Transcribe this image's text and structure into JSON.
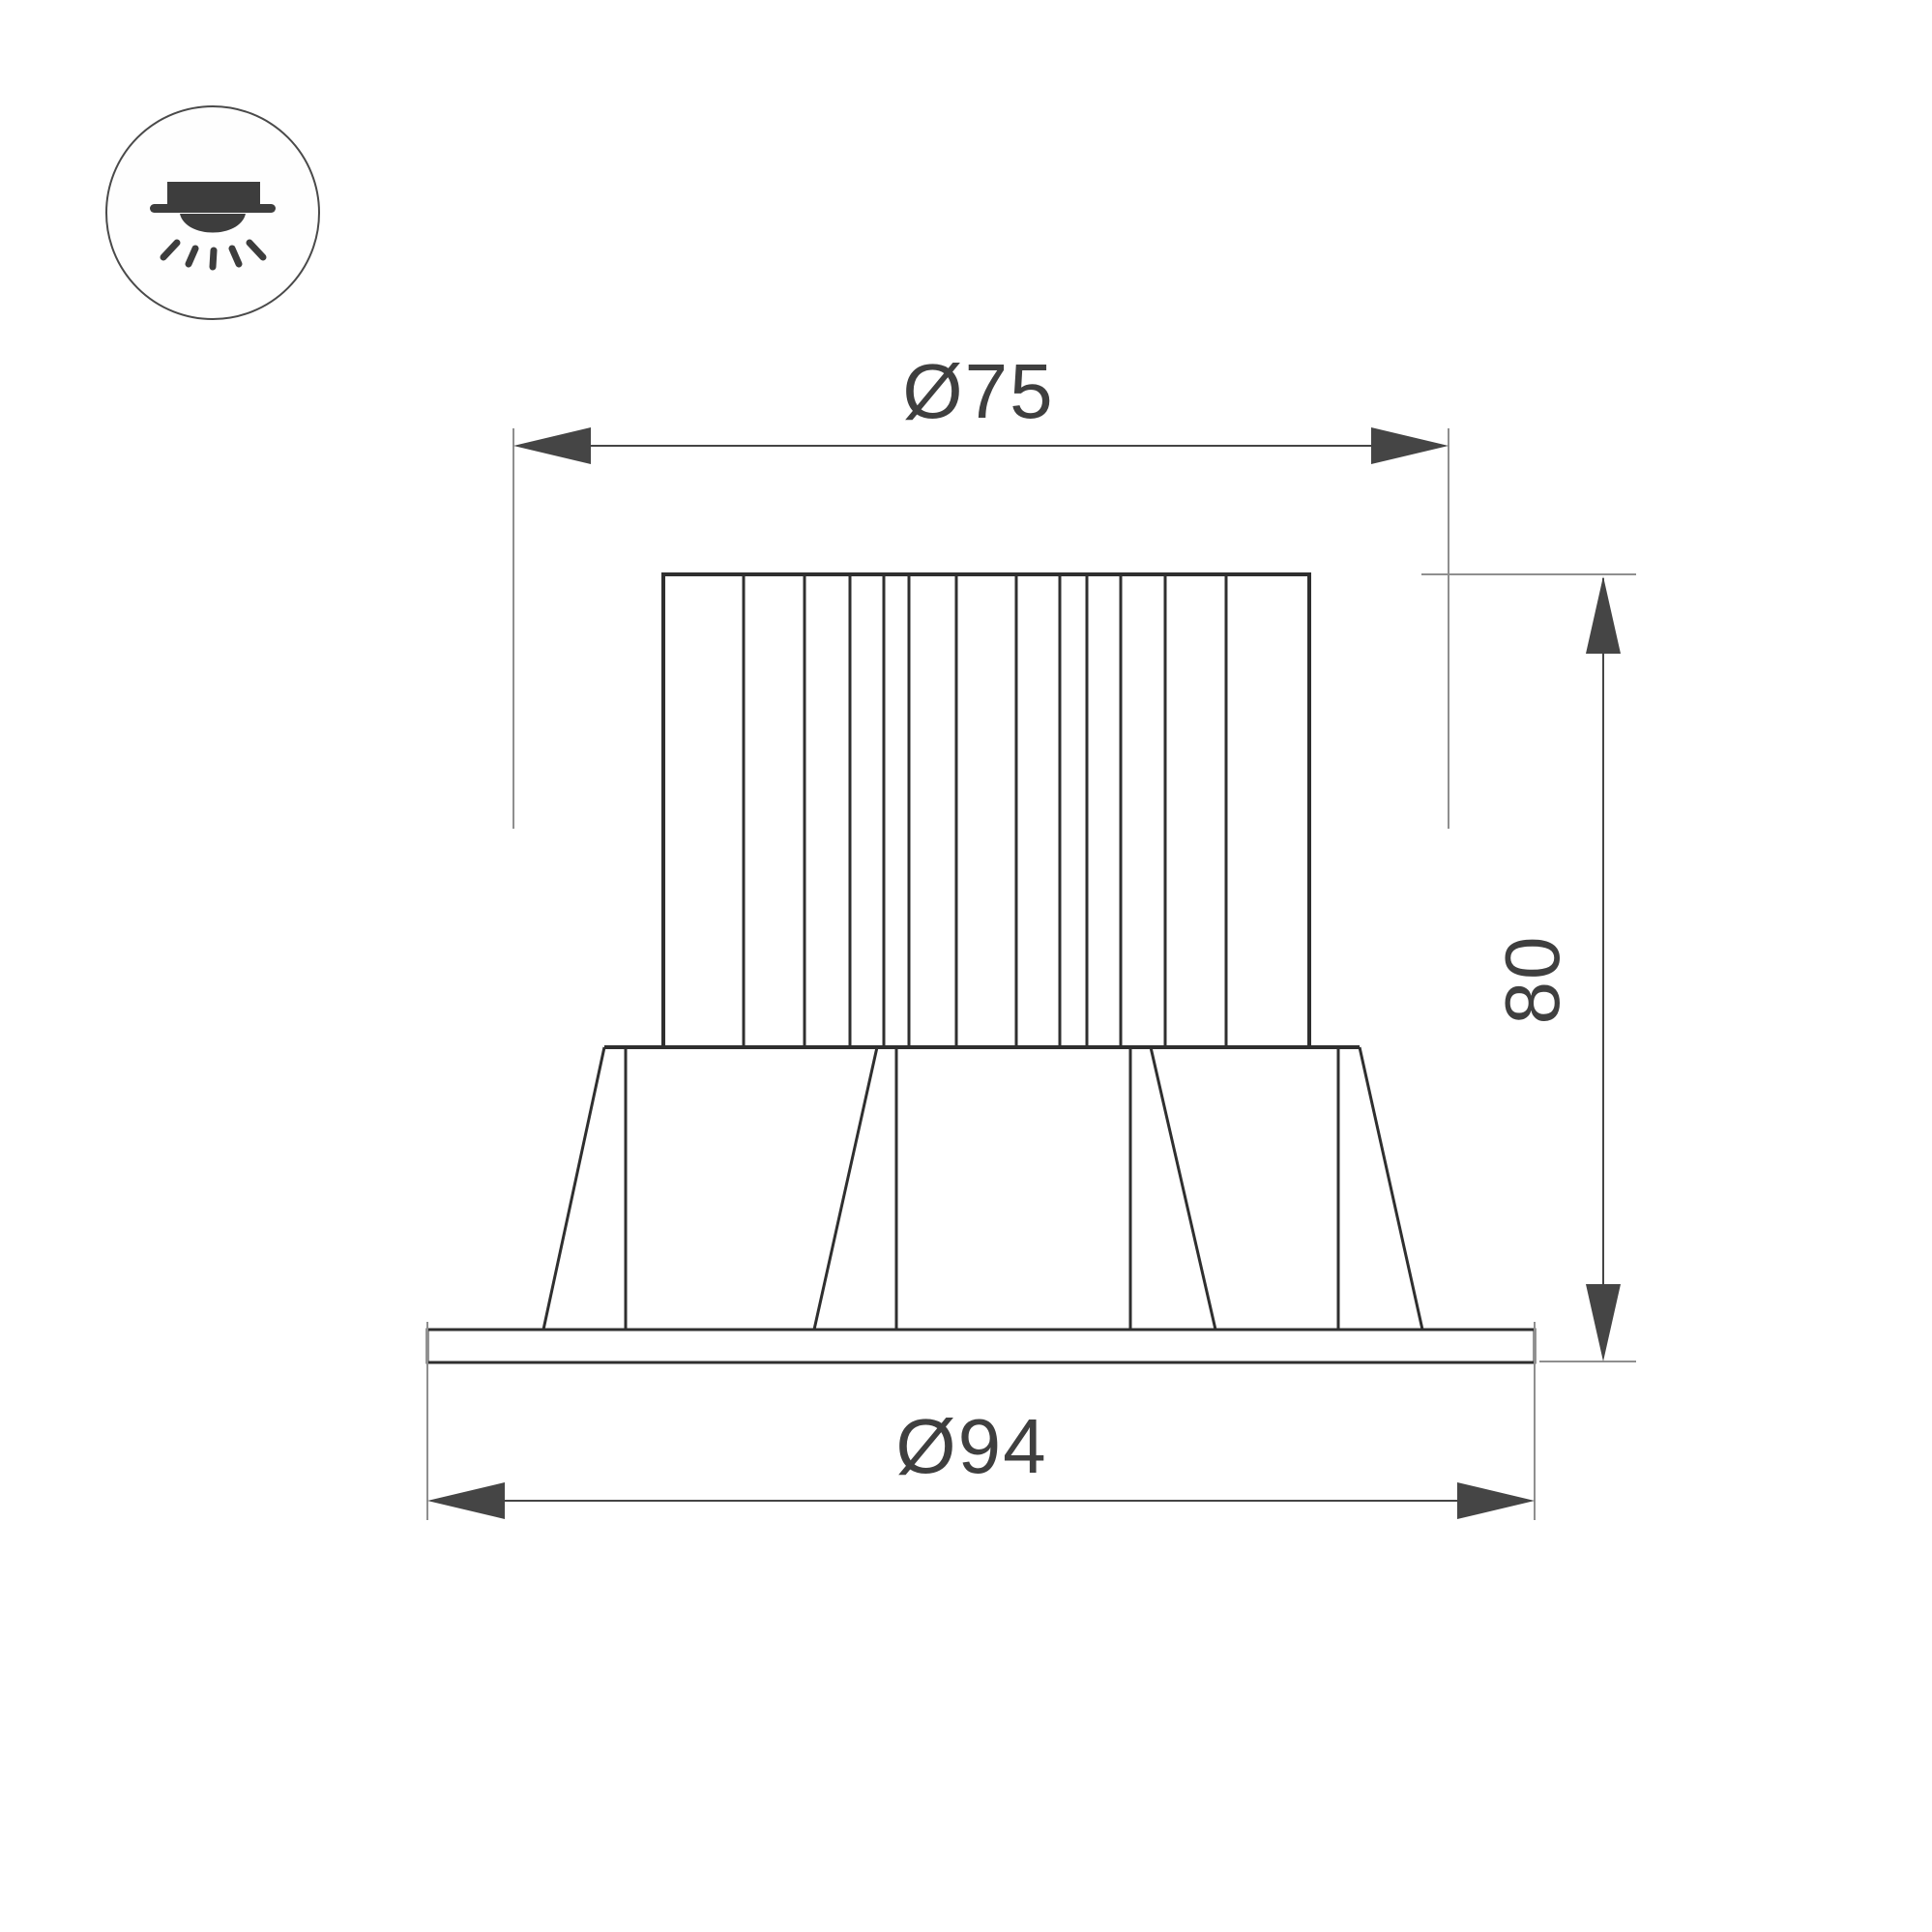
{
  "drawing": {
    "title": "recessed-downlight-dimension-drawing",
    "icon": {
      "name": "recessed-downlight-icon"
    },
    "dimensions": {
      "top_diameter": {
        "label": "Ø75",
        "value": 75
      },
      "height": {
        "label": "80",
        "value": 80
      },
      "bottom_diameter": {
        "label": "Ø94",
        "value": 94
      }
    },
    "colors": {
      "background": "#ffffff",
      "object_line": "#2f2f2f",
      "dimension_line": "#454545",
      "extension_line": "#8f8f8f",
      "text": "#3f3f3f",
      "icon": "#3d3d3d"
    }
  }
}
